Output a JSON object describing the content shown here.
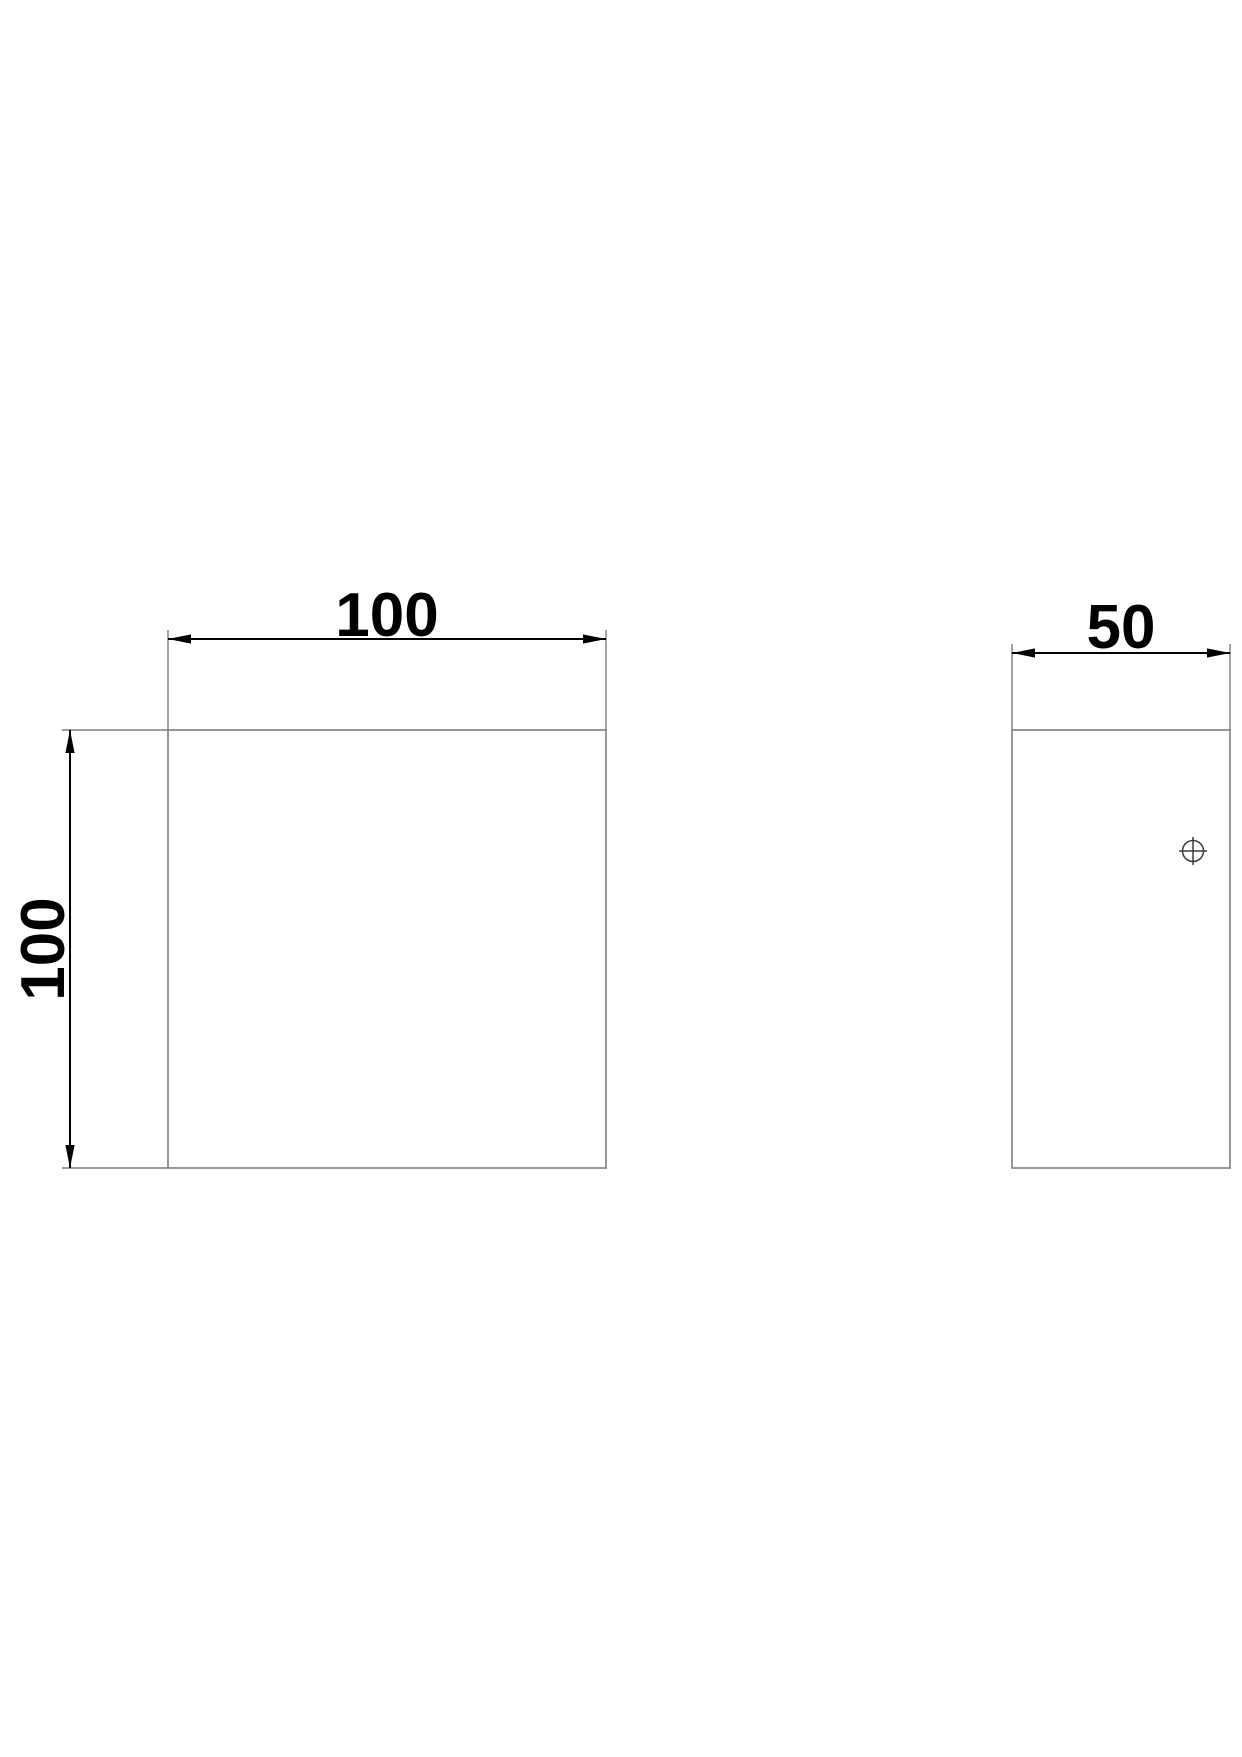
{
  "drawing": {
    "kind": "technical-dimension-drawing",
    "background_color": "#ffffff",
    "object_line_color": "#7d7d7d",
    "dimension_line_color": "#000000",
    "text_color": "#000000"
  },
  "views": {
    "front": {
      "width_dim": {
        "label": "100"
      },
      "height_dim": {
        "label": "100"
      }
    },
    "side": {
      "width_dim": {
        "label": "50"
      },
      "hole_marker": {
        "symbol": "crosshair-circle"
      }
    }
  }
}
